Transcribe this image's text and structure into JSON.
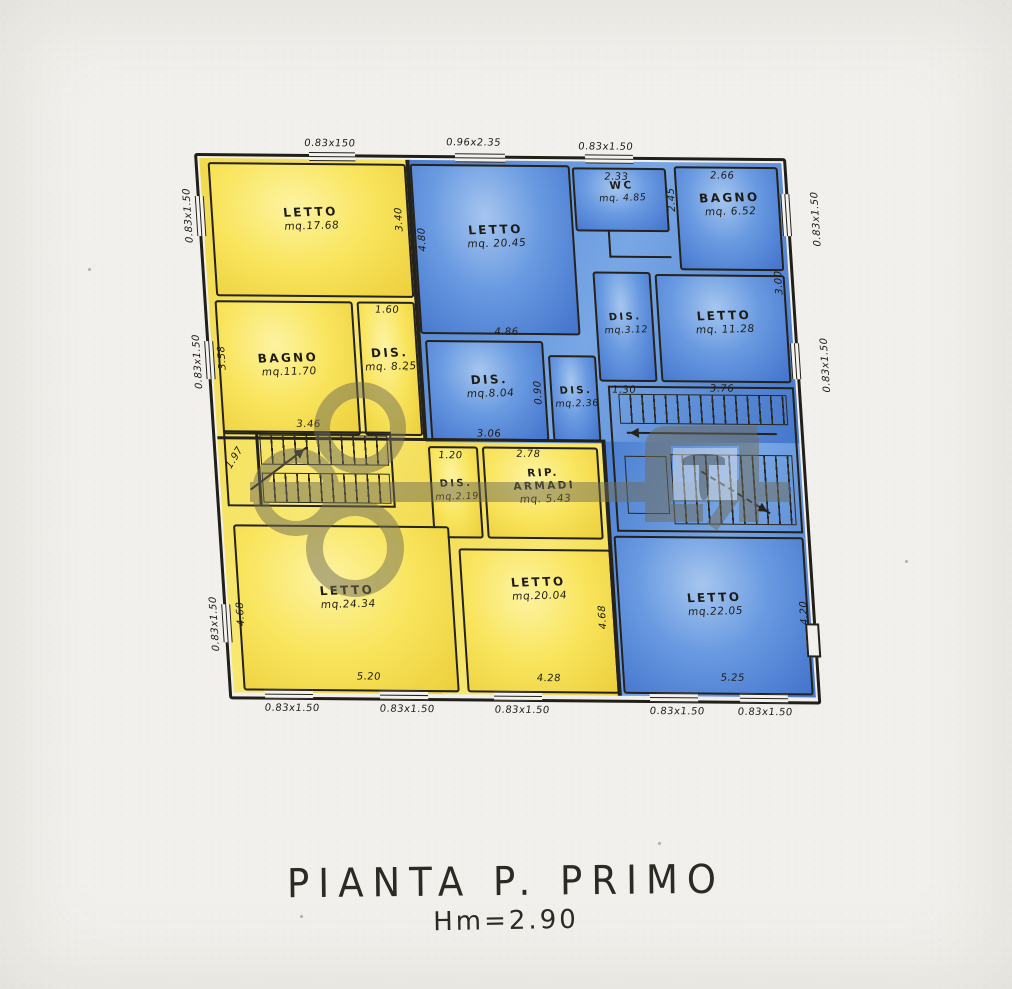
{
  "title": {
    "main": "PIANTA P. PRIMO",
    "height": "Hm=2.90"
  },
  "colors": {
    "paper": "#f1f0ec",
    "yellow": "#f8e45c",
    "blue": "#5587d7",
    "ink": "#24221b",
    "watermark": "#6f6b57"
  },
  "rooms": [
    {
      "name": "LETTO",
      "area": "mq.17.68",
      "wing": "yellow"
    },
    {
      "name": "BAGNO",
      "area": "mq.11.70",
      "wing": "yellow"
    },
    {
      "name": "DIS.",
      "area": "mq. 8.25",
      "wing": "yellow"
    },
    {
      "name": "DIS.",
      "area": "mq.2.19",
      "wing": "yellow"
    },
    {
      "name": "RIP. ARMADI",
      "area": "mq. 5.43",
      "wing": "yellow"
    },
    {
      "name": "LETTO",
      "area": "mq.24.34",
      "wing": "yellow"
    },
    {
      "name": "LETTO",
      "area": "mq.20.04",
      "wing": "yellow"
    },
    {
      "name": "LETTO",
      "area": "mq. 20.45",
      "wing": "blue"
    },
    {
      "name": "WC",
      "area": "mq. 4.85",
      "wing": "blue"
    },
    {
      "name": "BAGNO",
      "area": "mq. 6.52",
      "wing": "blue"
    },
    {
      "name": "DIS.",
      "area": "mq.8.04",
      "wing": "blue"
    },
    {
      "name": "DIS.",
      "area": "mq.2.36",
      "wing": "blue"
    },
    {
      "name": "DIS.",
      "area": "mq.3.12",
      "wing": "blue"
    },
    {
      "name": "LETTO",
      "area": "mq. 11.28",
      "wing": "blue"
    },
    {
      "name": "LETTO",
      "area": "mq.22.05",
      "wing": "blue"
    }
  ],
  "dims": {
    "top1": "0.83x150",
    "top2": "0.96x2.35",
    "top3": "0.83x1.50",
    "v233": "2.33",
    "v266": "2.66",
    "v245": "2.45",
    "v340": "3.40",
    "v480": "4.80",
    "v160": "1.60",
    "v358": "3.58",
    "v486": "4.86",
    "v306": "3.06",
    "v130": "1.30",
    "v376": "3.76",
    "v300": "3.00",
    "v346": "3.46",
    "v197": "1.97",
    "v120": "1.20",
    "v278": "2.78",
    "v090": "0.90",
    "v468a": "4.68",
    "v520": "5.20",
    "v428": "4.28",
    "v468b": "4.68",
    "v525": "5.25",
    "v420": "4.20"
  },
  "windows": {
    "left1": "0.83x1.50",
    "left2": "0.83x1.50",
    "left3": "0.83x1.50",
    "right1": "0.83x1.50",
    "right2": "0.83x1.50",
    "bottom1": "0.83x1.50",
    "bottom2": "0.83x1.50",
    "bottom3": "0.83x1.50",
    "bottom4": "0.83x1.50",
    "bottom5": "0.83x1.50"
  }
}
